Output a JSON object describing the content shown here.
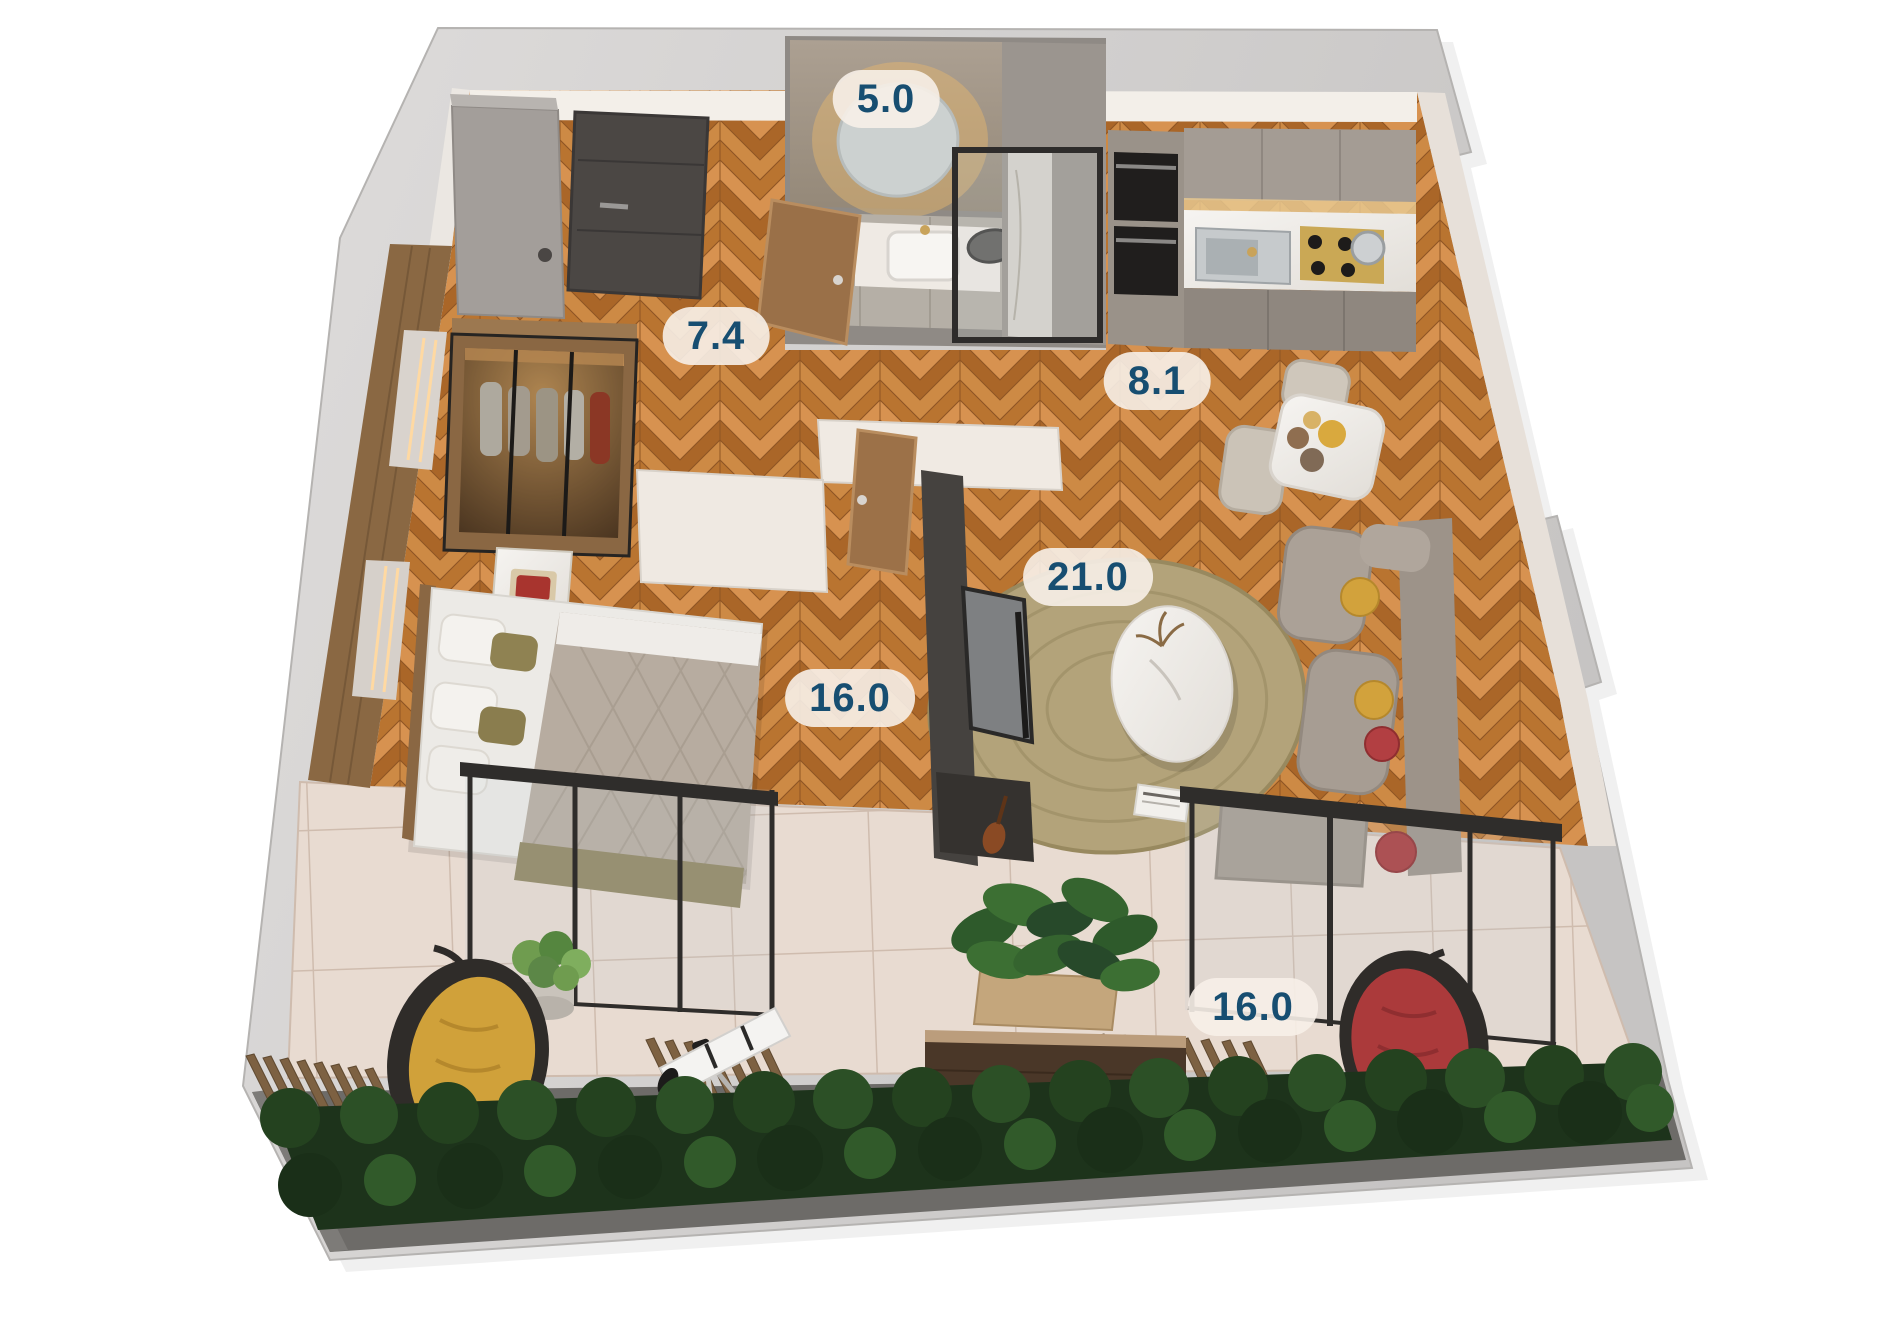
{
  "page": {
    "type": "3d-apartment-floor-plan-render",
    "background": "#ffffff"
  },
  "palette": {
    "label_text": "#174e71",
    "label_pill_bg": "rgba(247,240,232,0.9)",
    "wood_floor": "#c5823f",
    "outer_wall": "#d0cecd",
    "balcony_tile": "#e8dbd1",
    "hedge_green": "#24421f",
    "sofa_taupe": "#a79d93",
    "pillow_yellow": "#d2a23c",
    "pillow_red": "#b23f42",
    "hanging_chair_yellow": "#d0a13a",
    "hanging_chair_red": "#ab3a3b"
  },
  "rooms": [
    {
      "id": "bathroom",
      "area": "5.0"
    },
    {
      "id": "hallway",
      "area": "7.4"
    },
    {
      "id": "kitchen-dining",
      "area": "8.1"
    },
    {
      "id": "living-room",
      "area": "21.0"
    },
    {
      "id": "bedroom",
      "area": "16.0"
    },
    {
      "id": "balcony",
      "area": "16.0"
    }
  ]
}
